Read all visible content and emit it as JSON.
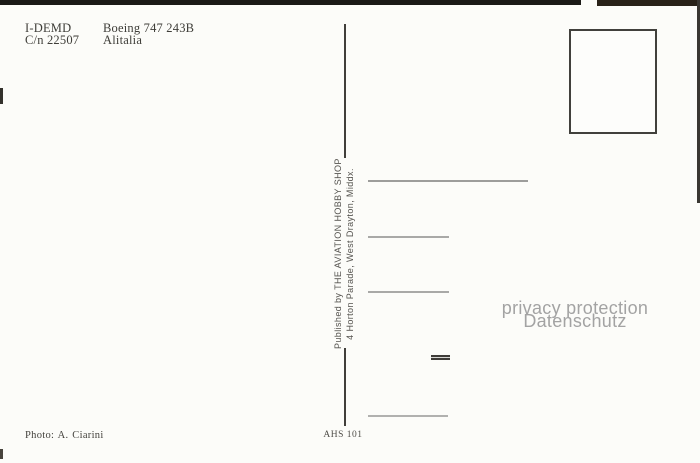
{
  "postcard": {
    "aircraft": {
      "registration": "I-DEMD",
      "construction_number": "C/n 22507",
      "type": "Boeing 747 243B",
      "airline": "Alitalia"
    },
    "publisher": {
      "line1": "Published by THE AVIATION HOBBY SHOP",
      "line2": "4 Horton Parade, West Drayton, Middx."
    },
    "watermark": {
      "line1": "privacy protection",
      "line2": "Datenschutz"
    },
    "photo_credit": "Photo: A. Ciarini",
    "catalog_number": "AHS 101",
    "colors": {
      "card_background": "#fcfcf9",
      "caption_ink": "#3e3d38",
      "publisher_ink": "#55534f",
      "divider": "#413f3b",
      "stamp_box_border": "#41403c",
      "address_line": "#a9a9a7",
      "watermark_gray": "#a3a3a3",
      "scan_edge_black": "#1b1a17"
    }
  }
}
